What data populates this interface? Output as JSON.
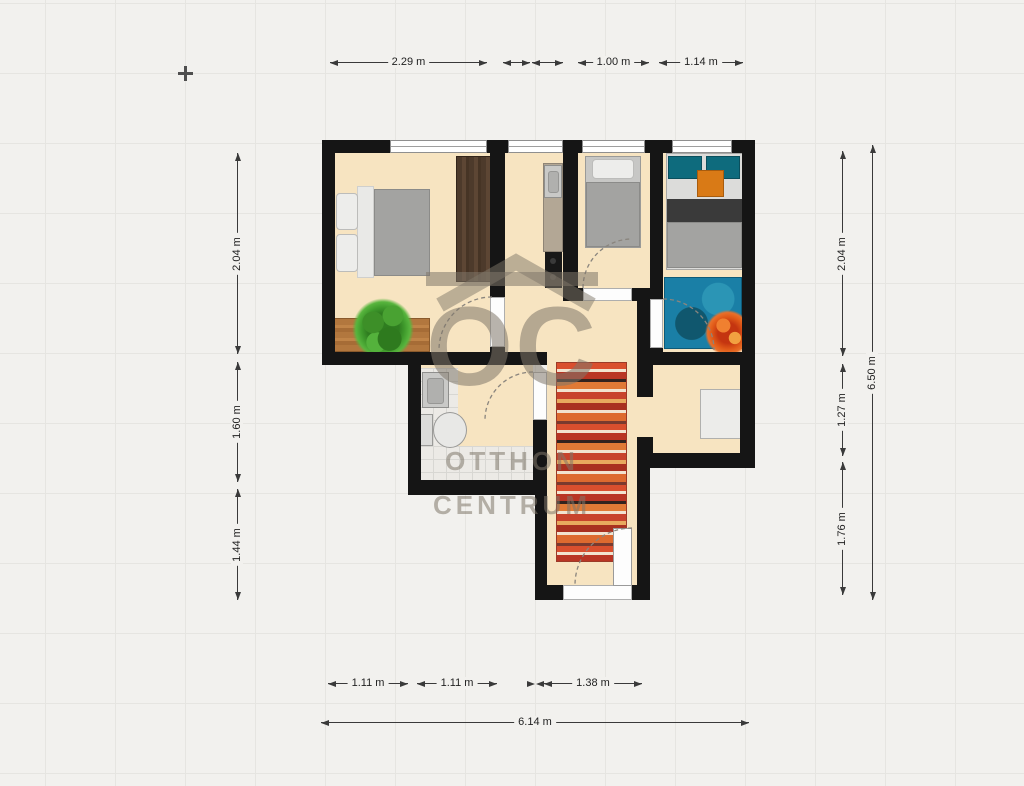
{
  "watermark": {
    "logo": "OC",
    "line1": "OTTHON",
    "line2": "CENTRUM"
  },
  "dimensions": {
    "top1": "2.29 m",
    "top2": "1.00 m",
    "top3": "1.14 m",
    "left1": "2.04 m",
    "left2": "1.60 m",
    "left3": "1.44 m",
    "right1": "2.04 m",
    "right2": "1.27 m",
    "right3": "1.76 m",
    "right_total": "6.50 m",
    "bottom1": "1.11 m",
    "bottom2": "1.11 m",
    "bottom3": "1.38 m",
    "bottom_total": "6.14 m"
  },
  "colors": {
    "background": "#f2f1ee",
    "wall": "#151515",
    "floor": "#f7e4c1",
    "dimension": "#3a3a3a",
    "watermark": "#80776a",
    "rug_primary": "#c0392b",
    "accent_teal": "#0e6b7d",
    "accent_orange": "#d97a16",
    "accent_blue_rug": "#1a7fa6"
  }
}
